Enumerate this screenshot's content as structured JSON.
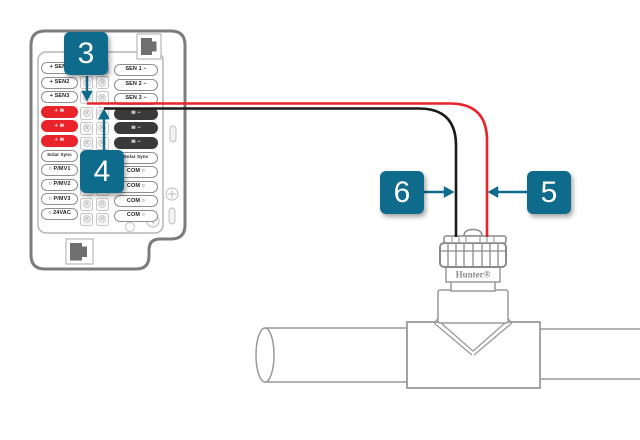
{
  "diagram": {
    "description": "Controller wiring to Hunter flow sensor on pipe tee"
  },
  "panel": {
    "left": [
      {
        "text": "+ SEN1"
      },
      {
        "text": "+ SEN2"
      },
      {
        "text": "+ SEN3"
      },
      {
        "text": "+ ≋"
      },
      {
        "text": "+ ≋"
      },
      {
        "text": "+ ≋"
      },
      {
        "text": "Solar Sync"
      },
      {
        "text": "○ P/MV1"
      },
      {
        "text": "○ P/MV2"
      },
      {
        "text": "○ P/MV3"
      },
      {
        "text": "○ 24VAC"
      }
    ],
    "right": [
      {
        "text": "SEN 1 −"
      },
      {
        "text": "SEN 2 −"
      },
      {
        "text": "SEN 3 −"
      },
      {
        "text": "≋ −"
      },
      {
        "text": "≋ −"
      },
      {
        "text": "≋ −"
      },
      {
        "text": "Solar Sync"
      },
      {
        "text": "COM ○"
      },
      {
        "text": "COM ○"
      },
      {
        "text": "COM ○"
      },
      {
        "text": "COM ○"
      }
    ]
  },
  "callouts": [
    {
      "number": "3"
    },
    {
      "number": "4"
    },
    {
      "number": "5"
    },
    {
      "number": "6"
    }
  ],
  "sensor": {
    "brand": "Hunter®"
  },
  "icons": {
    "rj45_port": "stepped dark square jack",
    "terminal_screw": "circle with ✕ screw head",
    "flow_symbol": "≋",
    "screw_head": "circle with cross"
  },
  "colors": {
    "accent_teal": "#0e6b8c",
    "wire_red": "#e8232a",
    "wire_black": "#1a1a1a",
    "terminal_red": "#e8232a",
    "terminal_dark": "#3a3a3a",
    "outline_gray": "#7c7c7c"
  }
}
